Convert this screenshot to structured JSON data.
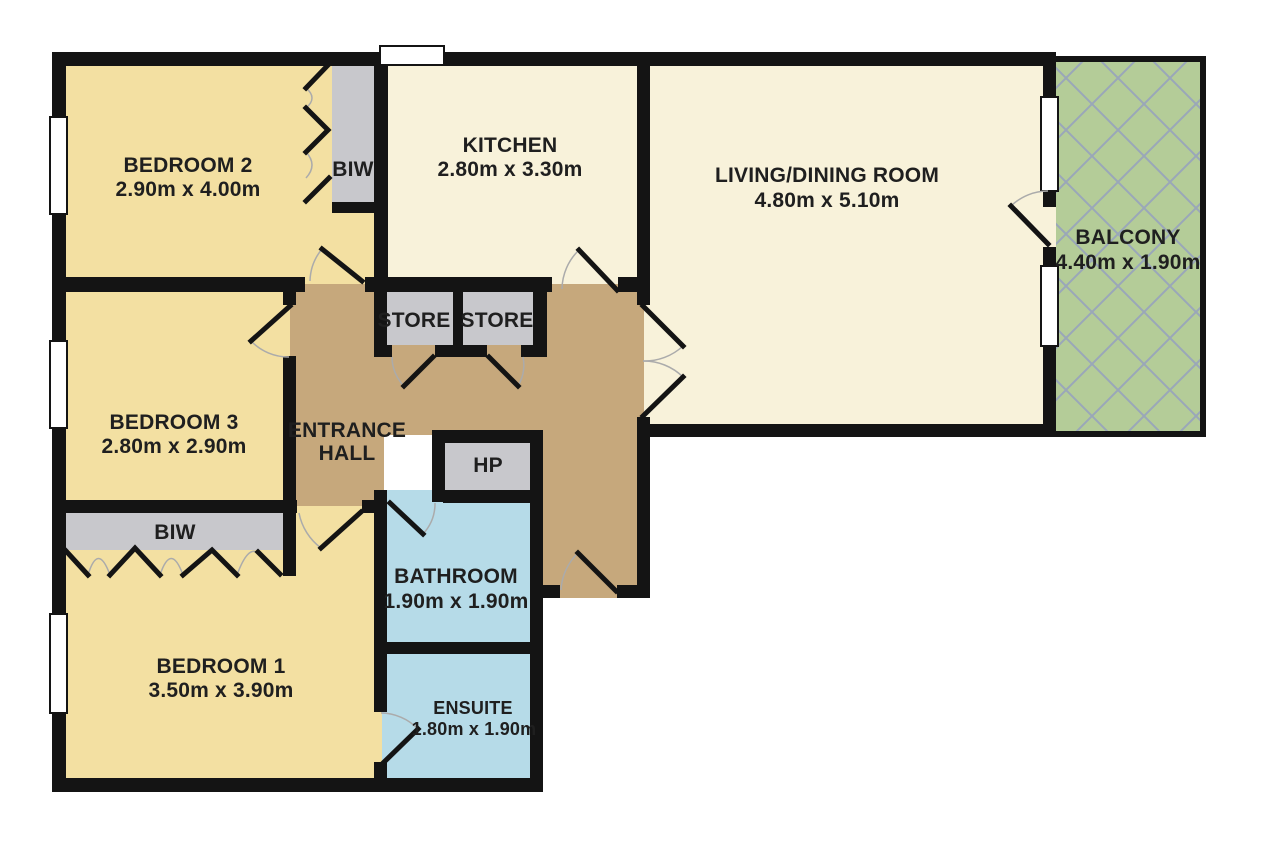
{
  "title": "Apartment floor plan",
  "colors": {
    "background": "#ffffff",
    "wall": "#141414",
    "bedroom": "#f3e0a2",
    "living_area": "#f8f2da",
    "hall": "#c6a87c",
    "closet": "#c8c8cc",
    "bathroom": "#b6dbe8",
    "balcony": "#b4cc98",
    "hatch_line": "#9aa7b9",
    "window": "#ffffff",
    "door_arc": "#ababab",
    "text": "#1f1f1f"
  },
  "rooms": {
    "bedroom2": {
      "name": "BEDROOM 2",
      "dims": "2.90m x 4.00m"
    },
    "kitchen": {
      "name": "KITCHEN",
      "dims": "2.80m x 3.30m"
    },
    "living": {
      "name": "LIVING/DINING ROOM",
      "dims": "4.80m x 5.10m"
    },
    "balcony": {
      "name": "BALCONY",
      "dims": "4.40m x 1.90m"
    },
    "bedroom3": {
      "name": "BEDROOM 3",
      "dims": "2.80m x 2.90m"
    },
    "hall": {
      "line1": "ENTRANCE",
      "line2": "HALL"
    },
    "bedroom1": {
      "name": "BEDROOM 1",
      "dims": "3.50m x 3.90m"
    },
    "bathroom": {
      "name": "BATHROOM",
      "dims": "1.90m x 1.90m"
    },
    "ensuite": {
      "name": "ENSUITE",
      "dims": "1.80m x 1.90m"
    },
    "store1": {
      "name": "STORE"
    },
    "store2": {
      "name": "STORE"
    },
    "hp": {
      "name": "HP"
    },
    "biw_bedroom2": {
      "name": "BIW"
    },
    "biw_bedroom1": {
      "name": "BIW"
    }
  }
}
